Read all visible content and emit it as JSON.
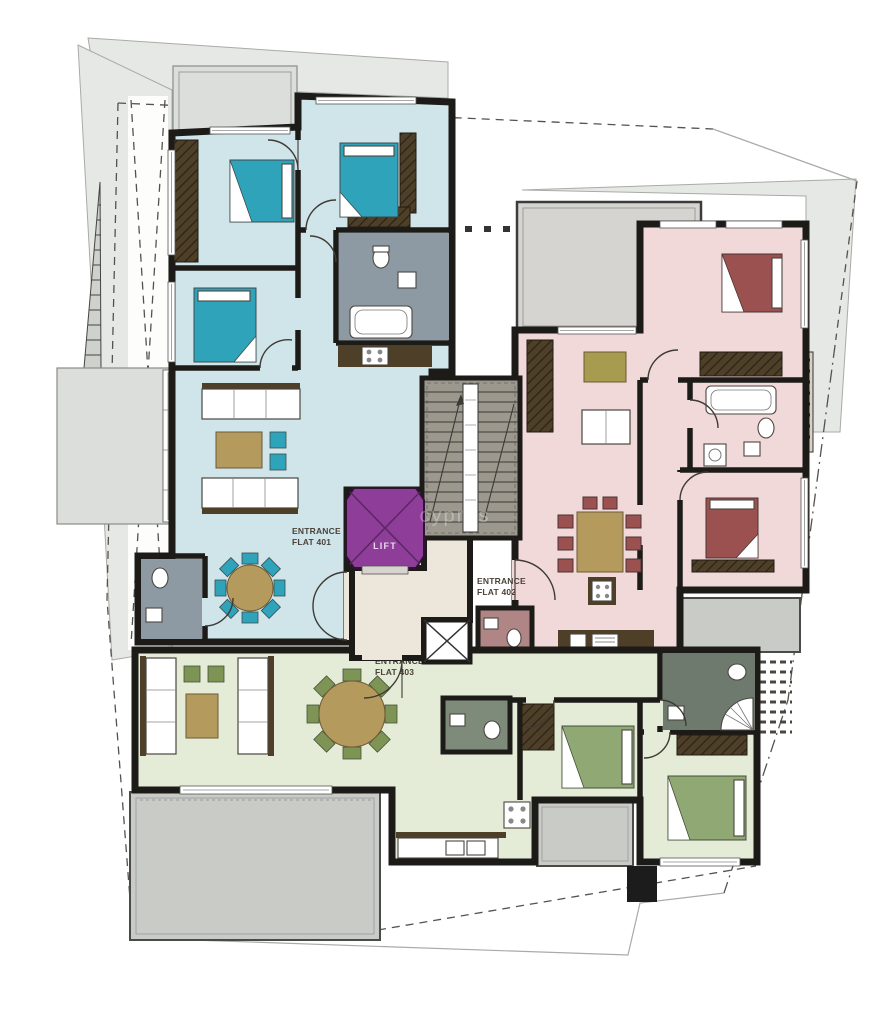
{
  "labels": {
    "flat401": {
      "line1": "ENTRANCE",
      "line2": "FLAT 401"
    },
    "flat402": {
      "line1": "ENTRANCE",
      "line2": "FLAT 402"
    },
    "flat403": {
      "line1": "ENTRANCE",
      "line2": "FLAT 403"
    },
    "lift": "LIFT"
  },
  "watermark": {
    "text": "cyprus"
  },
  "colors": {
    "wall": "#1d1b18",
    "line": "#3f3b34",
    "site": "#e6e8e5",
    "terrace": "#c9cbc7",
    "terraceLight": "#dcdedb",
    "flat401": "#cfe5ea",
    "flat402": "#f0d9d8",
    "flat403": "#e4ecd7",
    "lift": "#8e3d98",
    "bedTeal": "#2fa3ba",
    "bedRed": "#9c5151",
    "bedGreen": "#8fa874",
    "chairGreen": "#7d9455",
    "wood": "#b59a5e",
    "olive": "#a79b4f",
    "darkwood": "#4e3f28",
    "bath": "#8d9aa3",
    "bathDark": "#6f7a6e",
    "wcMauve": "#b08585",
    "cream": "#ece7da",
    "stair": "#9c988e"
  }
}
